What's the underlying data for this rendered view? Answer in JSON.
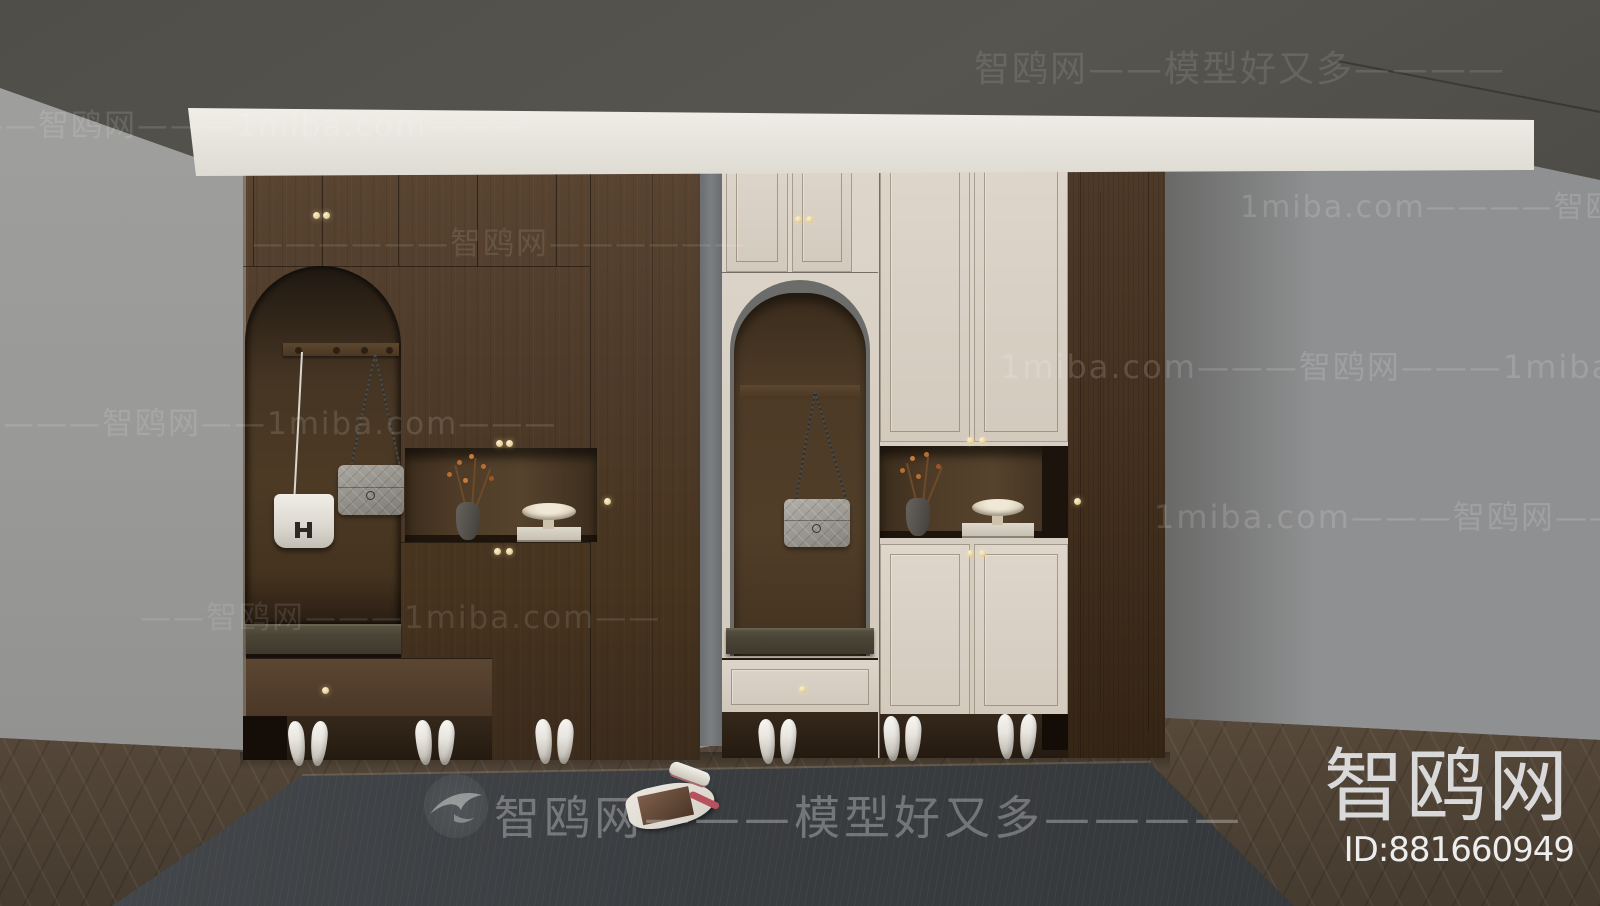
{
  "image_type": "3d-interior-render-preview",
  "subject": "Dark walnut entryway cloakroom / shoe cabinets with arched coat niches, display shelves, designer handbags, white high heels, herringbone floor and dark rug",
  "watermarks": {
    "brand": "智鸥网",
    "tagline": "模型好又多",
    "site": "1miba.com",
    "rows": [
      {
        "text": "智鸥网——模型好又多————"
      },
      {
        "text": "——智鸥网———1miba.com———"
      },
      {
        "text": "1miba.com————智鸥网———"
      },
      {
        "text": "——————智鸥网——————"
      },
      {
        "text": "1miba.com———智鸥网———1miba.com"
      },
      {
        "text": "————智鸥网——1miba.com———"
      },
      {
        "text": "1miba.com———智鸥网————"
      },
      {
        "text": "——智鸥网———1miba.com——"
      },
      {
        "text": "智鸥网———模型好又多————"
      }
    ]
  },
  "brand_badge": {
    "logo_text": "智鸥网",
    "model_id": "ID:881660949"
  },
  "scene": {
    "room": {
      "ceiling_color": "#55534e",
      "wall_color": "#9c9c9a",
      "crown_molding_color": "#ece9e3",
      "floor": "dark walnut herringbone parquet",
      "rug_color": "#3d4042"
    },
    "left_cabinet": {
      "material": "dark walnut wood",
      "features": [
        "arched coat niche with hook rail",
        "white leather flap bag with H clasp",
        "gray quilted chain bag",
        "open display niche with vase and pedestal bowl",
        "bench seat cushion",
        "shoe drawer",
        "small brass knobs"
      ]
    },
    "right_cabinet": {
      "material": "dark walnut + cream lacquer doors",
      "features": [
        "arched coat niche with gray trim",
        "gray quilted chain bag",
        "open display niche with vase and pedestal bowl",
        "bench seat cushion",
        "cream drawer",
        "small brass knobs",
        "tall walnut side column"
      ]
    },
    "decor": [
      {
        "name": "vase with orange blossom branches",
        "count": 2
      },
      {
        "name": "cream pedestal bowl on book",
        "count": 2
      },
      {
        "name": "white high-heel shoes",
        "pairs": 6
      },
      {
        "name": "open magazine on rug",
        "count": 1
      }
    ]
  }
}
